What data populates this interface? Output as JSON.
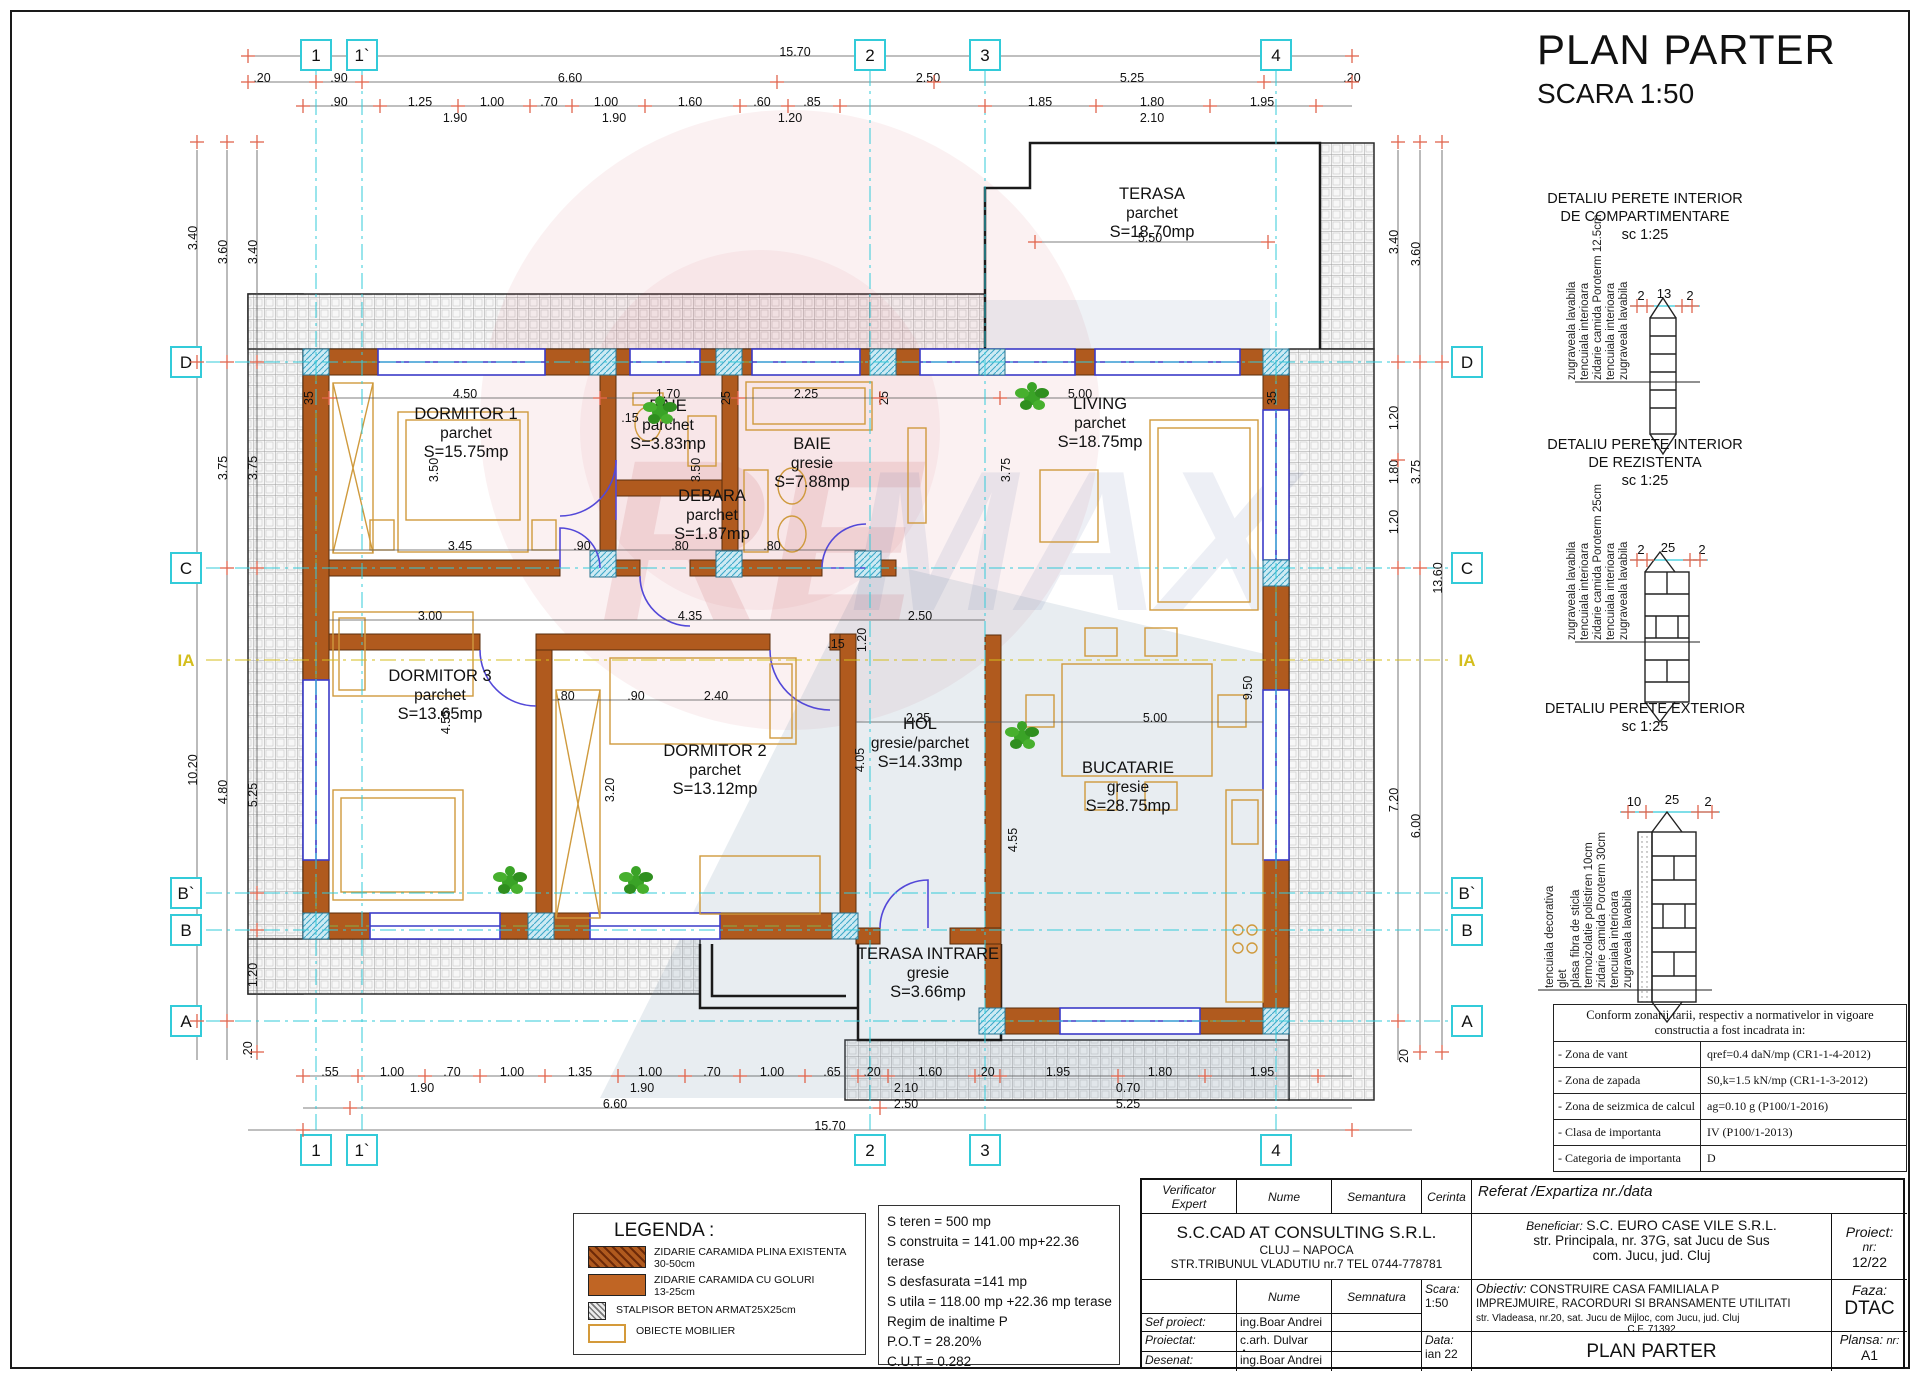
{
  "sheet": {
    "title": "PLAN PARTER",
    "scale": "SCARA  1:50"
  },
  "grid": {
    "cols": [
      {
        "label": "1",
        "x": 316
      },
      {
        "label": "1`",
        "x": 362
      },
      {
        "label": "2",
        "x": 870
      },
      {
        "label": "3",
        "x": 985
      },
      {
        "label": "4",
        "x": 1276
      }
    ],
    "rows": [
      {
        "label": "D",
        "y": 362
      },
      {
        "label": "C",
        "y": 568
      },
      {
        "label": "IA",
        "y": 660,
        "yellow": true
      },
      {
        "label": "B`",
        "y": 893
      },
      {
        "label": "B",
        "y": 930
      },
      {
        "label": "A",
        "y": 1021
      }
    ]
  },
  "rooms": [
    {
      "name": "TERASA",
      "finish": "parchet",
      "area": "S=18.70mp",
      "cx": 1152,
      "cy": 218
    },
    {
      "name": "DORMITOR 1",
      "finish": "parchet",
      "area": "S=15.75mp",
      "cx": 466,
      "cy": 438
    },
    {
      "name": "BAIE",
      "finish": "parchet",
      "area": "S=3.83mp",
      "cx": 668,
      "cy": 430
    },
    {
      "name": "BAIE",
      "finish": "gresie",
      "area": "S=7.88mp",
      "cx": 812,
      "cy": 468
    },
    {
      "name": "LIVING",
      "finish": "parchet",
      "area": "S=18.75mp",
      "cx": 1100,
      "cy": 428
    },
    {
      "name": "DEBARA",
      "finish": "parchet",
      "area": "S=1.87mp",
      "cx": 712,
      "cy": 520
    },
    {
      "name": "DORMITOR 3",
      "finish": "parchet",
      "area": "S=13.65mp",
      "cx": 440,
      "cy": 700
    },
    {
      "name": "DORMITOR 2",
      "finish": "parchet",
      "area": "S=13.12mp",
      "cx": 715,
      "cy": 775
    },
    {
      "name": "HOL",
      "finish": "gresie/parchet",
      "area": "S=14.33mp",
      "cx": 920,
      "cy": 748
    },
    {
      "name": "BUCATARIE",
      "finish": "gresie",
      "area": "S=28.75mp",
      "cx": 1128,
      "cy": 792
    },
    {
      "name": "TERASA INTRARE",
      "finish": "gresie",
      "area": "S=3.66mp",
      "cx": 928,
      "cy": 978
    }
  ],
  "details": [
    {
      "t1": "DETALIU PERETE INTERIOR",
      "t2": "DE COMPARTIMENTARE",
      "sc": "sc  1:25",
      "layers": [
        "zugraveala lavabila",
        "tencuiala interioara",
        "zidarie camida Poroterm 12.5cm",
        "tencuiala interioara",
        "zugraveala lavabila"
      ],
      "d": [
        "2",
        "13",
        "2"
      ]
    },
    {
      "t1": "DETALIU PERETE INTERIOR",
      "t2": "DE REZISTENTA",
      "sc": "sc  1:25",
      "layers": [
        "zugraveala lavabila",
        "tencuiala interioara",
        "zidarie camida Poroterm 25cm",
        "tencuiala interioara",
        "zugraveala lavabila"
      ],
      "d": [
        "2",
        "25",
        "2"
      ]
    },
    {
      "t1": "DETALIU PERETE EXTERIOR",
      "t2": "",
      "sc": "sc  1:25",
      "layers": [
        "tencuiala decorativa",
        "glet",
        "plasa fibra de sticla",
        "termoizolatie polistiren 10cm",
        "zidarie camida Poroterm 30cm",
        "tencuiala interioara",
        "zugraveala lavabila"
      ],
      "d": [
        "10",
        "25",
        "2"
      ]
    }
  ],
  "norms": {
    "h1": "Conform zonarii tarii, respectiv a normativelor in vigoare",
    "h2": "constructia a fost incadrata in:",
    "rows": [
      [
        "- Zona de vant",
        "qref=0.4 daN/mp  (CR1-1-4-2012)"
      ],
      [
        "- Zona de zapada",
        "S0,k=1.5 kN/mp    (CR1-1-3-2012)"
      ],
      [
        "- Zona de seizmica de calcul",
        "ag=0.10 g        (P100/1-2016)"
      ],
      [
        "- Clasa de importanta",
        "IV              (P100/1-2013)"
      ],
      [
        "- Categoria de importanta",
        "D"
      ]
    ]
  },
  "legend": {
    "title": "LEGENDA :",
    "items": [
      {
        "l1": "ZIDARIE CARAMIDA PLINA EXISTENTA",
        "l2": "30-50cm"
      },
      {
        "l1": "ZIDARIE CARAMIDA CU GOLURI",
        "l2": "13-25cm"
      },
      {
        "l1": "STALPISOR BETON ARMAT25X25cm",
        "l2": ""
      },
      {
        "l1": "OBIECTE MOBILIER",
        "l2": ""
      }
    ]
  },
  "stats": [
    "S teren = 500 mp",
    "S construita = 141.00 mp+22.36 terase",
    "S desfasurata =141 mp",
    "S utila = 118.00 mp +22.36 mp terase",
    "Regim de inaltime P",
    "P.O.T = 28.20%",
    "C.U.T =  0.282"
  ],
  "titleblock": {
    "v1": "Verificator",
    "v2": "Expert",
    "nume": "Nume",
    "semantura": "Semantura",
    "cerinta": "Cerinta",
    "referat": "Referat /Expartiza nr./data",
    "company": "S.C.CAD AT CONSULTING  S.R.L.",
    "company2": "CLUJ – NAPOCA",
    "company3": "STR.TRIBUNUL VLADUTIU nr.7  TEL 0744-778781",
    "beneficiar_label": "Beneficiar:",
    "beneficiar1": "S.C. EURO CASE VILE S.R.L.",
    "beneficiar2": "str. Principala, nr. 37G, sat Jucu de Sus",
    "beneficiar3": "com. Jucu, jud. Cluj",
    "proiect_label": "Proiect:",
    "proiect_label2": "nr:",
    "proiect_nr": "12/22",
    "nume2": "Nume",
    "semnatura2": "Semnatura",
    "scara_label": "Scara:",
    "scara": "1:50",
    "obiectiv_label": "Obiectiv:",
    "obiectiv1": "CONSTRUIRE CASA FAMILIALA P",
    "obiectiv2": "IMPREJMUIRE, RACORDURI SI BRANSAMENTE UTILITATI",
    "obiectiv3": "str. Vladeasa, nr.20, sat. Jucu de Mijloc, com Jucu, jud. Cluj",
    "obiectiv4": "C.F.  71392",
    "faza_label": "Faza:",
    "faza": "DTAC",
    "sef": "Sef proiect:",
    "sef_n": "ing.Boar Andrei",
    "proiectat": "Proiectat:",
    "proiectat_n": "c.arh. Dulvar Ana",
    "desenat": "Desenat:",
    "desenat_n": "ing.Boar Andrei",
    "data_label": "Data:",
    "data": "ian 22",
    "plansa_title": "PLAN PARTER",
    "plansa_label": "Plansa:",
    "plansa_label2": "nr:",
    "plansa_nr": "A1"
  },
  "colors": {
    "wall": "#b05a1e",
    "furniture": "#cf9a3d",
    "window": "#3b3bc8",
    "axis": "#33cbd9",
    "tick": "#e0654d",
    "ia": "#d4be1d"
  },
  "dims": [
    [
      "15.70",
      795,
      56,
      0
    ],
    [
      ".20",
      262,
      82,
      0
    ],
    [
      ".90",
      339,
      82,
      0
    ],
    [
      "6.60",
      570,
      82,
      0
    ],
    [
      "2.50",
      928,
      82,
      0
    ],
    [
      "5.25",
      1132,
      82,
      0
    ],
    [
      ".20",
      1352,
      82,
      0
    ],
    [
      ".90",
      339,
      106,
      0
    ],
    [
      "1.25",
      420,
      106,
      0
    ],
    [
      "1.00",
      492,
      106,
      0
    ],
    [
      ".70",
      549,
      106,
      0
    ],
    [
      "1.00",
      606,
      106,
      0
    ],
    [
      "1.60",
      690,
      106,
      0
    ],
    [
      ".60",
      762,
      106,
      0
    ],
    [
      ".85",
      812,
      106,
      0
    ],
    [
      "1.85",
      1040,
      106,
      0
    ],
    [
      "1.80",
      1152,
      106,
      0
    ],
    [
      "1.95",
      1262,
      106,
      0
    ],
    [
      "1.90",
      455,
      122,
      0
    ],
    [
      "1.90",
      614,
      122,
      0
    ],
    [
      "1.20",
      790,
      122,
      0
    ],
    [
      "2.10",
      1152,
      122,
      0
    ],
    [
      "5.50",
      1150,
      242,
      0
    ],
    [
      "3.40",
      197,
      238,
      1
    ],
    [
      "10.20",
      197,
      770,
      1
    ],
    [
      "3.60",
      227,
      252,
      1
    ],
    [
      "3.75",
      227,
      468,
      1
    ],
    [
      "4.80",
      227,
      792,
      1
    ],
    [
      "3.40",
      257,
      252,
      1
    ],
    [
      "3.75",
      257,
      468,
      1
    ],
    [
      "5.25",
      257,
      795,
      1
    ],
    [
      "1.20",
      257,
      975,
      1
    ],
    [
      ".20",
      252,
      1050,
      1
    ],
    [
      "3.40",
      1398,
      242,
      1
    ],
    [
      "1.20",
      1398,
      418,
      1
    ],
    [
      "1.80",
      1398,
      472,
      1
    ],
    [
      "1.20",
      1398,
      522,
      1
    ],
    [
      "7.20",
      1398,
      800,
      1
    ],
    [
      "3.60",
      1420,
      254,
      1
    ],
    [
      "3.75",
      1420,
      472,
      1
    ],
    [
      "6.00",
      1420,
      826,
      1
    ],
    [
      "13.60",
      1442,
      578,
      1
    ],
    [
      "20",
      1408,
      1056,
      1
    ],
    [
      ".55",
      330,
      1076,
      0
    ],
    [
      "1.00",
      392,
      1076,
      0
    ],
    [
      ".70",
      452,
      1076,
      0
    ],
    [
      "1.00",
      512,
      1076,
      0
    ],
    [
      "1.35",
      580,
      1076,
      0
    ],
    [
      "1.00",
      650,
      1076,
      0
    ],
    [
      ".70",
      712,
      1076,
      0
    ],
    [
      "1.00",
      772,
      1076,
      0
    ],
    [
      ".65",
      832,
      1076,
      0
    ],
    [
      ".20",
      872,
      1076,
      0
    ],
    [
      "1.60",
      930,
      1076,
      0
    ],
    [
      ".20",
      986,
      1076,
      0
    ],
    [
      "1.95",
      1058,
      1076,
      0
    ],
    [
      "1.80",
      1160,
      1076,
      0
    ],
    [
      "1.95",
      1262,
      1076,
      0
    ],
    [
      "1.90",
      422,
      1092,
      0
    ],
    [
      "1.90",
      642,
      1092,
      0
    ],
    [
      "2.10",
      906,
      1092,
      0
    ],
    [
      "0.70",
      1128,
      1092,
      0
    ],
    [
      "6.60",
      615,
      1108,
      0
    ],
    [
      "2.50",
      906,
      1108,
      0
    ],
    [
      "5.25",
      1128,
      1108,
      0
    ],
    [
      "15.70",
      830,
      1130,
      0
    ],
    [
      "4.50",
      465,
      398,
      0
    ],
    [
      "1.70",
      668,
      398,
      0
    ],
    [
      "2.25",
      806,
      398,
      0
    ],
    [
      "5.00",
      1080,
      398,
      0
    ],
    [
      ".15",
      630,
      422,
      0
    ],
    [
      "35",
      313,
      398,
      1
    ],
    [
      "25",
      730,
      398,
      1
    ],
    [
      "25",
      888,
      398,
      1
    ],
    [
      "35",
      1276,
      398,
      1
    ],
    [
      "3.50",
      438,
      470,
      1
    ],
    [
      "3.50",
      700,
      470,
      1
    ],
    [
      "3.75",
      1010,
      470,
      1
    ],
    [
      "3.45",
      460,
      550,
      0
    ],
    [
      ".90",
      582,
      550,
      0
    ],
    [
      ".80",
      680,
      550,
      0
    ],
    [
      ".80",
      772,
      550,
      0
    ],
    [
      "3.00",
      430,
      620,
      0
    ],
    [
      "4.35",
      690,
      620,
      0
    ],
    [
      "1.20",
      866,
      640,
      1
    ],
    [
      ".15",
      836,
      648,
      0
    ],
    [
      ".80",
      566,
      700,
      0
    ],
    [
      ".90",
      636,
      700,
      0
    ],
    [
      "2.40",
      716,
      700,
      0
    ],
    [
      "4.55",
      450,
      722,
      1
    ],
    [
      "3.20",
      614,
      790,
      1
    ],
    [
      "2.50",
      920,
      620,
      0
    ],
    [
      "2.25",
      918,
      722,
      0
    ],
    [
      "4.05",
      864,
      760,
      1
    ],
    [
      "5.00",
      1155,
      722,
      0
    ],
    [
      "4.55",
      1017,
      840,
      1
    ],
    [
      "9.50",
      1252,
      688,
      1
    ]
  ],
  "ticks": {
    "rows": [
      {
        "y": 56,
        "xs": [
          248,
          1352
        ]
      },
      {
        "y": 82,
        "xs": [
          248,
          316,
          362,
          777,
          934,
          1264,
          1352
        ]
      },
      {
        "y": 106,
        "xs": [
          303,
          380,
          458,
          530,
          572,
          645,
          740,
          788,
          840,
          985,
          1096,
          1210,
          1316
        ]
      },
      {
        "y": 242,
        "xs": [
          1035,
          1268
        ]
      },
      {
        "y": 398,
        "xs": [
          329,
          600,
          738,
          880,
          1000
        ]
      },
      {
        "y": 1076,
        "xs": [
          303,
          358,
          425,
          480,
          545,
          618,
          685,
          740,
          805,
          858,
          888,
          975,
          1000,
          1118,
          1205,
          1318
        ]
      },
      {
        "y": 1108,
        "xs": [
          350,
          880
        ]
      },
      {
        "y": 1130,
        "xs": [
          303,
          1352
        ]
      }
    ],
    "cols": [
      {
        "x": 197,
        "ys": [
          142,
          362,
          1021
        ]
      },
      {
        "x": 227,
        "ys": [
          142,
          362,
          568,
          1021
        ]
      },
      {
        "x": 257,
        "ys": [
          142,
          362,
          568,
          893,
          930,
          1052
        ]
      },
      {
        "x": 1398,
        "ys": [
          142,
          362,
          460,
          568,
          1021
        ]
      },
      {
        "x": 1420,
        "ys": [
          142,
          362,
          568,
          1052
        ]
      },
      {
        "x": 1442,
        "ys": [
          142,
          362,
          1052
        ]
      }
    ],
    "cyan": [
      {
        "y": 306,
        "xs": [
          1637,
          1647,
          1682,
          1692
        ]
      },
      {
        "y": 560,
        "xs": [
          1637,
          1647,
          1690,
          1700
        ]
      },
      {
        "y": 812,
        "xs": [
          1628,
          1646,
          1698,
          1712
        ]
      }
    ]
  },
  "plants": [
    {
      "x": 660,
      "y": 412
    },
    {
      "x": 1032,
      "y": 398
    },
    {
      "x": 510,
      "y": 882
    },
    {
      "x": 636,
      "y": 882
    },
    {
      "x": 1022,
      "y": 737
    }
  ]
}
